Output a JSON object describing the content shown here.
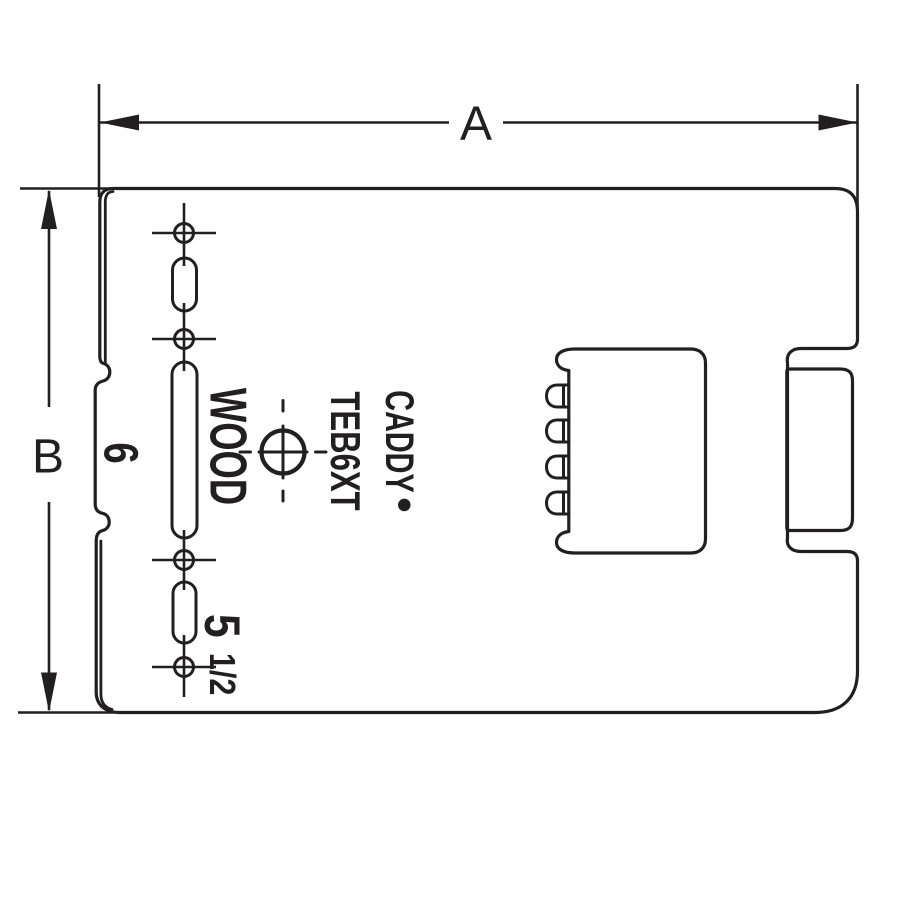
{
  "drawing": {
    "dimension_labels": {
      "width": "A",
      "height": "B"
    },
    "markings": {
      "brand": "CADDY",
      "registered_mark": "•",
      "model": "TEB6XT",
      "material": "WOOD",
      "spacing_six": "6",
      "spacing_five": "5",
      "spacing_five_fraction": "1/2"
    },
    "colors": {
      "line": "#231f20",
      "background": "#ffffff"
    }
  }
}
